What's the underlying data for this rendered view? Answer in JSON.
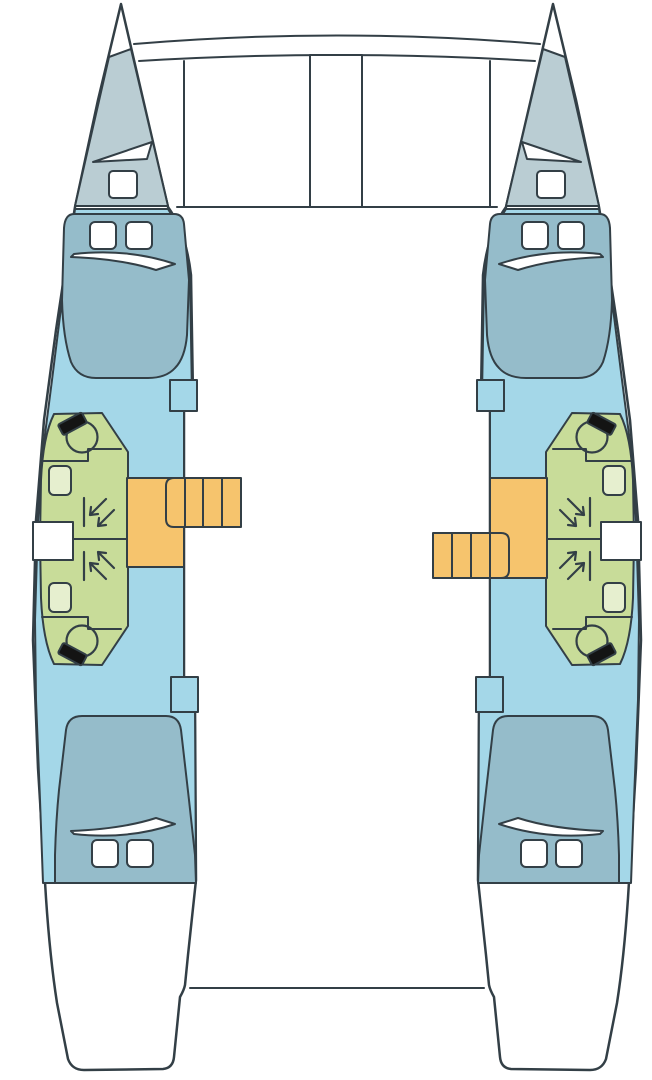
{
  "page": {
    "title": "Catamaran deck plan",
    "kind": "boat-floor-plan"
  },
  "colors": {
    "background": "#ffffff",
    "outline": "#333f46",
    "hull": "#ffffff",
    "cabin_blue": "#a4d7e8",
    "bed_blue": "#95bcca",
    "locker_gray": "#bacdd3",
    "heads_green": "#c8dc99",
    "sink": "#e6efcf",
    "stairs_orange": "#f6c46d",
    "toilet_lid": "#141414",
    "white_fittings": "#ffffff"
  },
  "plan": {
    "hulls": 2,
    "double_cabins": 4,
    "heads_with_shower": 4,
    "toilets": 4,
    "sinks": 4,
    "companionway_stairs": 2,
    "stair_treads_per_stair": 4,
    "pillows_per_berth": 2,
    "bow_lockers": 2,
    "foredeck_beams": 2
  },
  "features": [
    "port-hull",
    "starboard-hull",
    "bow-trampoline",
    "forward-crossbeam",
    "mast-step-beam",
    "forward-cabin-berth",
    "aft-cabin-berth",
    "toilet",
    "sink",
    "shower-corner-arrows",
    "companionway-steps",
    "stair-landing",
    "deck-hatch",
    "anchor-locker",
    "stern-platform"
  ]
}
